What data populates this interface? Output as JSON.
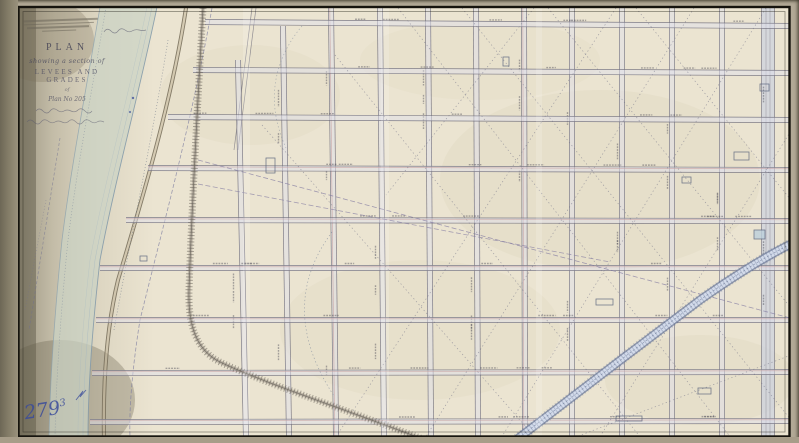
{
  "sheet": {
    "handwritten_number": "279",
    "handwritten_number_superscript": "3"
  },
  "title_block": {
    "plan_label": "PLAN",
    "subtitle_script": "showing a section of",
    "subject_caps": "LEVEES AND GRADES",
    "connector_script": "of",
    "plan_ref_script": "Plan No 205",
    "illegible_script_line_count": 2
  },
  "stamp": {
    "illegible_line_count": 4,
    "legible": false
  },
  "map_annotations": {
    "street_name_labels_legible": false,
    "vertical_streets": 12,
    "horizontal_streets": 9
  },
  "colors": {
    "paper": "#ebe4d1",
    "margin": "#b2a996",
    "frame": "#16140e",
    "river": "#cbd3c5",
    "canal_blue": "#d3dbeb",
    "street_edge": "#6e6c7a",
    "handwriting_ink": "#3b4c9b"
  }
}
